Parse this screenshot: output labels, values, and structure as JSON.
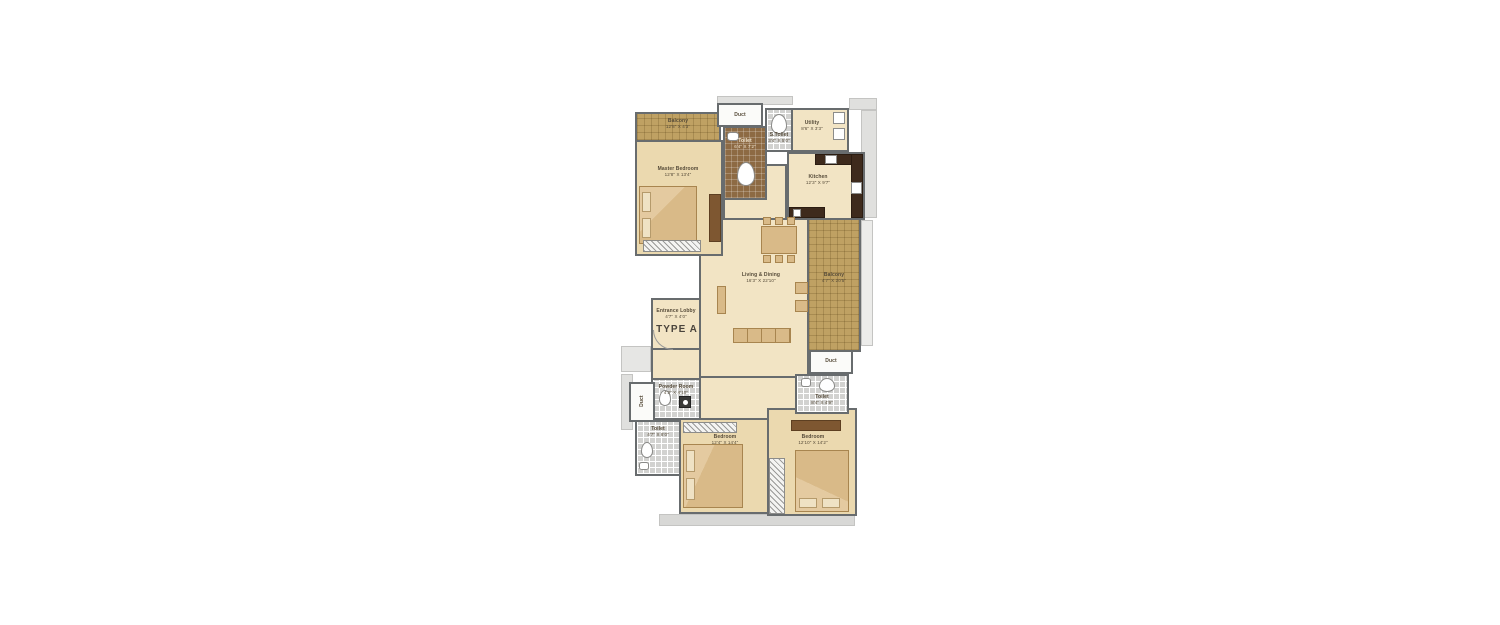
{
  "plan": {
    "type_label": "TYPE A",
    "rooms": {
      "balcony_top": {
        "name": "Balcony",
        "dims": "12'8\" X 4'3\""
      },
      "master_bedroom": {
        "name": "Master Bedroom",
        "dims": "12'8\" X 13'4\""
      },
      "duct_top": {
        "name": "Duct"
      },
      "toilet_master": {
        "name": "Toilet",
        "dims": "6'4\" X 7'2\""
      },
      "s_toilet": {
        "name": "S.Toilet",
        "dims": "3'4\" X 5'0\""
      },
      "utility": {
        "name": "Utility",
        "dims": "8'6\" X 3'3\""
      },
      "kitchen": {
        "name": "Kitchen",
        "dims": "12'3\" X 9'7\""
      },
      "living_dining": {
        "name": "Living & Dining",
        "dims": "16'3\" X 22'10\""
      },
      "balcony_right": {
        "name": "Balcony",
        "dims": "4'7\" X 20'5\""
      },
      "entrance_lobby": {
        "name": "Entrance Lobby",
        "dims": "4'7\" X 4'0\""
      },
      "powder_room": {
        "name": "Powder Room",
        "dims": "4'3\" X 4'10\""
      },
      "duct_left": {
        "name": "Duct"
      },
      "toilet_left": {
        "name": "Toilet",
        "dims": "4'7\" X 8'0\""
      },
      "bedroom_left": {
        "name": "Bedroom",
        "dims": "12'4\" X 14'4\""
      },
      "bedroom_right": {
        "name": "Bedroom",
        "dims": "12'10\" X 14'2\""
      },
      "toilet_right": {
        "name": "Toilet",
        "dims": "8'4\" X 4'9\""
      },
      "duct_right": {
        "name": "Duct"
      }
    },
    "colors": {
      "wall": "#686c6e",
      "floor_cream": "#f2e4c4",
      "floor_bedroom": "#ebd9af",
      "balcony_khaki": "#bfa163",
      "toilet_tile": "#d2d2d0",
      "toilet_brown": "#8d6a43",
      "kitchen_counter": "#3e2a1c",
      "furniture": "#d9ba88"
    }
  }
}
